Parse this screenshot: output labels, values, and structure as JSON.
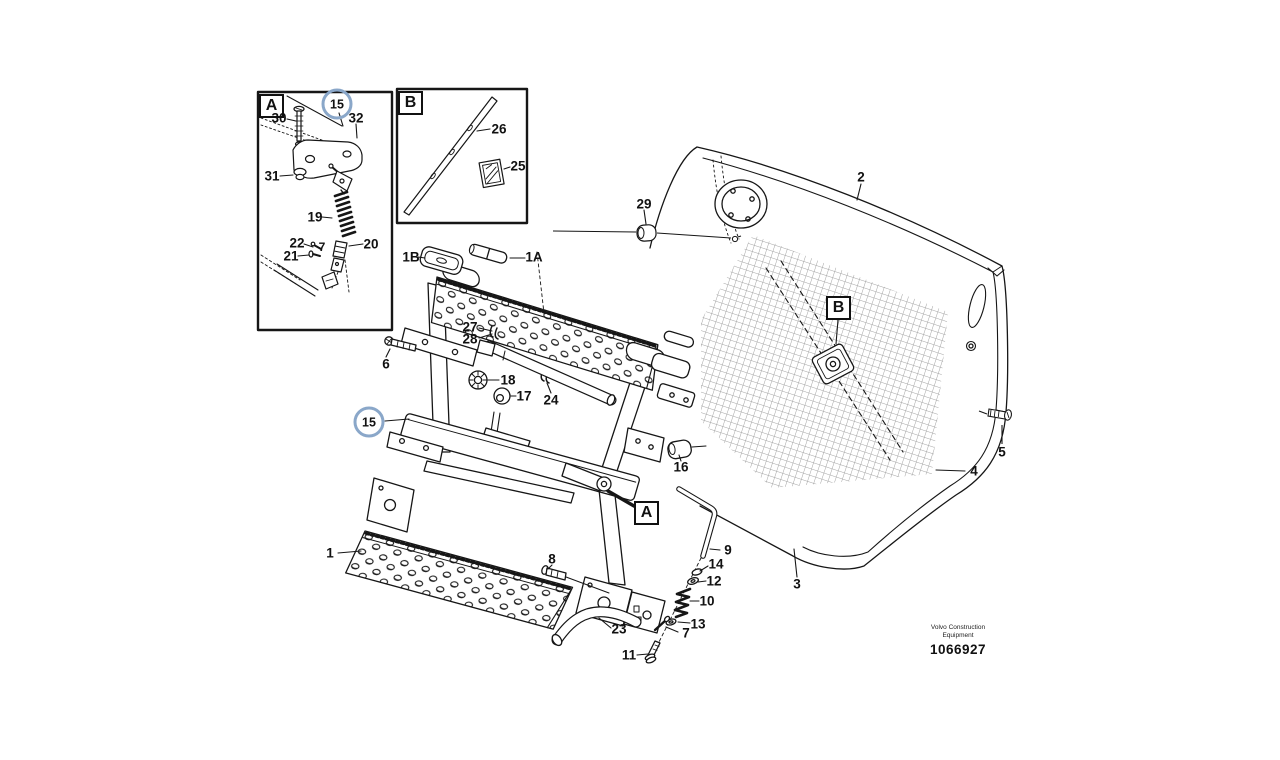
{
  "document": {
    "brand_line1": "Volvo Construction",
    "brand_line2": "Equipment",
    "number": "1066927"
  },
  "detail_views": {
    "a": {
      "letter": "A"
    },
    "b": {
      "letter": "B"
    }
  },
  "detail_markers": {
    "a": "A",
    "b": "B"
  },
  "highlight": {
    "label": "15",
    "color": "#8aa7c9"
  },
  "callouts": [
    {
      "label": "1"
    },
    {
      "label": "1A"
    },
    {
      "label": "1B"
    },
    {
      "label": "2"
    },
    {
      "label": "3"
    },
    {
      "label": "4"
    },
    {
      "label": "5"
    },
    {
      "label": "6"
    },
    {
      "label": "7"
    },
    {
      "label": "8"
    },
    {
      "label": "9"
    },
    {
      "label": "10"
    },
    {
      "label": "11"
    },
    {
      "label": "12"
    },
    {
      "label": "13"
    },
    {
      "label": "14"
    },
    {
      "label": "16"
    },
    {
      "label": "17"
    },
    {
      "label": "18"
    },
    {
      "label": "23"
    },
    {
      "label": "24"
    },
    {
      "label": "27"
    },
    {
      "label": "28"
    },
    {
      "label": "29"
    },
    {
      "label": "30"
    },
    {
      "label": "31"
    },
    {
      "label": "32"
    },
    {
      "label": "19"
    },
    {
      "label": "20"
    },
    {
      "label": "21"
    },
    {
      "label": "22"
    },
    {
      "label": "7"
    },
    {
      "label": "26"
    },
    {
      "label": "25"
    }
  ]
}
